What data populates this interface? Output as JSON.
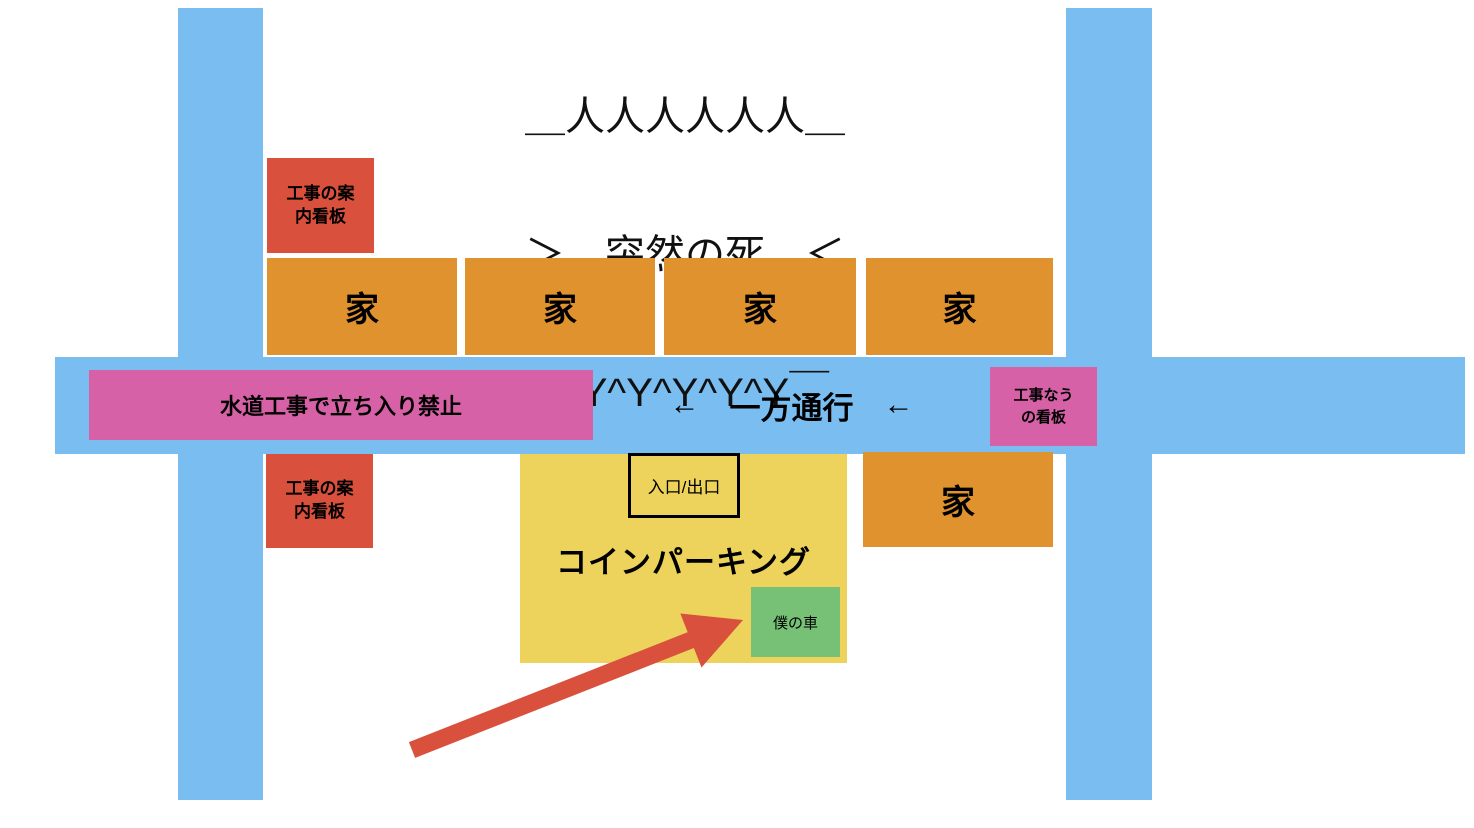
{
  "meme_banner": {
    "line1": "＿人人人人人人＿",
    "line2": "＞　突然の死　＜",
    "line3": "￣Y^Y^Y^Y^Y￣"
  },
  "signs": {
    "construction_info_top": "工事の案内看板",
    "construction_info_bottom": "工事の案内看板",
    "water_works_no_entry": "水道工事で立ち入り禁止",
    "construction_now": "工事なうの看板"
  },
  "street": {
    "one_way_label": "一方通行",
    "direction_arrow": "←"
  },
  "houses": {
    "top_row": [
      "家",
      "家",
      "家",
      "家"
    ],
    "south_house": "家"
  },
  "parking": {
    "label": "コインパーキング",
    "entrance_exit": "入口/出口",
    "my_car": "僕の車"
  },
  "colors": {
    "road": "#7ABDF0",
    "house": "#E0922E",
    "red_sign": "#D9503C",
    "pink_sign": "#D661A6",
    "parking": "#EDD35C",
    "car_green": "#76C175",
    "arrow": "#D9503C",
    "text": "#000000"
  }
}
